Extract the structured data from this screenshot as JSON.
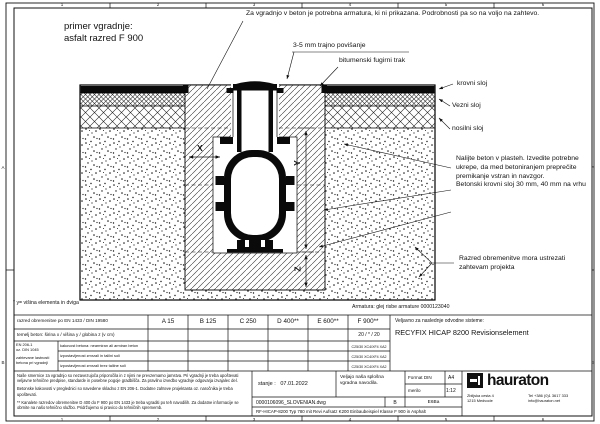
{
  "header": {
    "example_line1": "primer vgradnje:",
    "example_line2": "asfalt razred F 900"
  },
  "annotations": {
    "rebar": "Za vgradnjo v beton je potrebna armatura, ki ni prikazana. Podrobnosti pa so na voljo na zahtevo.",
    "rise": "3-5 mm trajno povišanje",
    "bitumen": "bitumenski fugirni trak",
    "layer_top": "krovni sloj",
    "layer_binder": "Vezni sloj",
    "layer_base": "nosilni sloj",
    "concrete": "Nalijte beton v plasteh. Izvedite potrebne ukrepe, da med betoniranjem preprečite premikanje vstran in navzgor.\nBetonski krovni sloj 30 mm, 40 mm na vrhu",
    "load_class": "Razred obremenitve mora ustrezati zahtevam projekta",
    "height_footnote": "* y= višina elementa in dviga",
    "rebar_ref": "Armatura: glej risbe armature 0000123040",
    "dim_x": "X",
    "dim_y": "Y",
    "dim_z": "Z"
  },
  "table": {
    "load_class_label": "razred obremenitve po EN 1433 / DIN 19580",
    "classes": [
      "A 15",
      "B 125",
      "C 250",
      "D 400**",
      "E 600**",
      "F 900**"
    ],
    "foundation_label": "temelj beton: širina x / višina y / globina z (v cm)",
    "foundation_f900": "20 / * / 20",
    "standard_line1": "EN 206-1",
    "standard_line2": "oz. DIN 1045",
    "standard_note": "zahtevane lastnosti betona pri vgradnji",
    "concrete_rows": [
      {
        "label": "kakovost betona: nearmiran ali armiran beton",
        "f900": "C25/30 XC4/XF4 XA2"
      },
      {
        "label": "izpostavljenost zmrzali in talilni soli",
        "f900": "C25/30 XC4/XF4 XA2"
      },
      {
        "label": "izpostavljenost zmrzali brez talilne soli",
        "f900": "C25/30 XC4/XF4 XA2"
      }
    ],
    "systems_label": "Veljavno za naslednje odvodne sisteme:",
    "systems_value": "RECYFIX HICAP 8200 Revisionselement"
  },
  "titleblock": {
    "notes_p1": "Naše smernice za vgradnjo so nezavezujoča priporočila in z njimi ne prevzemamo jamstva. Pri vgradnji je treba upoštevati veljavne tehnične predpise, standarde in posebne pogoje gradbišča. Za pravilno izvedbo vgradnje odgovarja izvajalec del.",
    "notes_p2": "Betonske kakovosti v preglednici so navedene skladno z EN 206-1. Dodatne zahteve projektanta oz. naročnika je treba upoštevati.",
    "notes_p3": "** Kanalete razredov obremenitve D 400 do F 900 po EN 1433 je treba vgraditi po teh navodilih. Za dodatne informacije se obrnite na našo tehnično službo. Pridržujemo si pravico do tehničnih sprememb.",
    "state_label": "stanje :",
    "state_date": "07.01.2022",
    "instructions": "Veljajo naša splošna vgradna navodila.",
    "format_label": "Format DIN",
    "format_value": "A4",
    "scale_label": "merilo",
    "scale_value": "1:12",
    "filename": "0000106096_SLOVENIAN.dwg",
    "revision": "B",
    "author": "E6Ba",
    "drawing_title": "RF-HICAP-8200 Typ 780 mit Revi Aufsatz K200 Einbaubeispiel Klasse F 900 in Asphalt",
    "brand": "hauraton",
    "address_line1": "Zbiljska cesta 4",
    "address_line2": "1215 Medvode",
    "tel": "Tel +386 (0)1 3617 333",
    "email": "info@hauraton.net"
  },
  "frame": {
    "cols": [
      "1",
      "2",
      "3",
      "4",
      "5",
      "6"
    ],
    "rows": [
      "A",
      "B"
    ]
  }
}
